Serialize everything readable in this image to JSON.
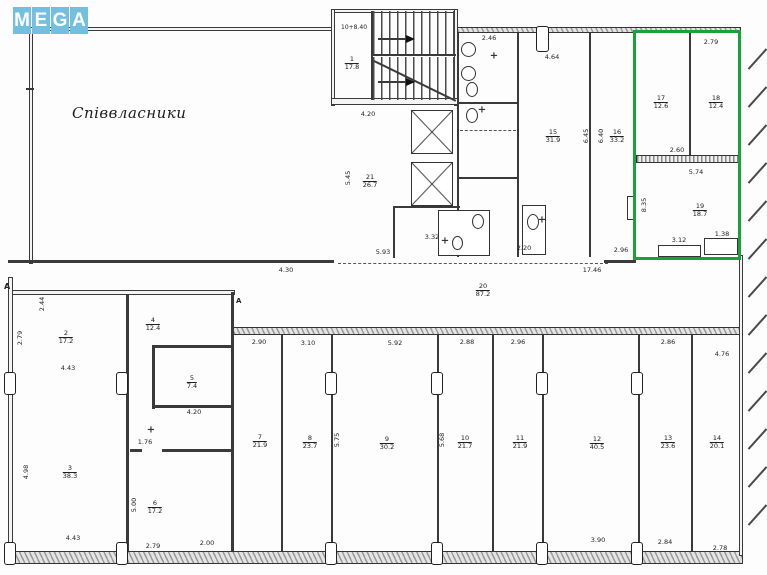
{
  "logo": {
    "letters": [
      "M",
      "E",
      "G",
      "A"
    ]
  },
  "plan": {
    "coowners_label": "Співвласники",
    "stair_level_mark": "10+8.40",
    "section_marker": "А",
    "highlight_color": "#18a33a",
    "rooms": [
      {
        "no": "1",
        "area": "17.8"
      },
      {
        "no": "21",
        "area": "26.7"
      },
      {
        "no": "15",
        "area": "31.9"
      },
      {
        "no": "16",
        "area": "33.2"
      },
      {
        "no": "17",
        "area": "12.6"
      },
      {
        "no": "18",
        "area": "12.4"
      },
      {
        "no": "19",
        "area": "18.7"
      },
      {
        "no": "20",
        "area": "87.2"
      },
      {
        "no": "2",
        "area": "17.2"
      },
      {
        "no": "3",
        "area": "38.3"
      },
      {
        "no": "4",
        "area": "12.4"
      },
      {
        "no": "5",
        "area": "7.4"
      },
      {
        "no": "6",
        "area": "17.2"
      },
      {
        "no": "7",
        "area": "21.9"
      },
      {
        "no": "8",
        "area": "23.7"
      },
      {
        "no": "9",
        "area": "30.2"
      },
      {
        "no": "10",
        "area": "21.7"
      },
      {
        "no": "11",
        "area": "21.9"
      },
      {
        "no": "12",
        "area": "40.5"
      },
      {
        "no": "13",
        "area": "23.6"
      },
      {
        "no": "14",
        "area": "20.1"
      }
    ],
    "dims": [
      {
        "v": "4.20"
      },
      {
        "v": "2.46"
      },
      {
        "v": "5.93"
      },
      {
        "v": "4.30"
      },
      {
        "v": "17.46"
      },
      {
        "v": "2.96"
      },
      {
        "v": "2.79"
      },
      {
        "v": "2.60"
      },
      {
        "v": "5.74"
      },
      {
        "v": "8.35"
      },
      {
        "v": "3.12"
      },
      {
        "v": "1.38"
      },
      {
        "v": "2.90"
      },
      {
        "v": "3.10"
      },
      {
        "v": "5.92"
      },
      {
        "v": "2.88"
      },
      {
        "v": "2.96"
      },
      {
        "v": "2.86"
      },
      {
        "v": "3.90"
      },
      {
        "v": "2.84"
      },
      {
        "v": "2.78"
      },
      {
        "v": "4.43"
      },
      {
        "v": "4.43"
      },
      {
        "v": "4.98"
      },
      {
        "v": "2.79"
      },
      {
        "v": "4.20"
      },
      {
        "v": "2.00"
      },
      {
        "v": "2.79"
      },
      {
        "v": "5.00"
      },
      {
        "v": "5.45"
      },
      {
        "v": "6.45"
      },
      {
        "v": "6.40"
      },
      {
        "v": "5.75"
      },
      {
        "v": "5.68"
      },
      {
        "v": "1.76"
      },
      {
        "v": "4.76"
      },
      {
        "v": "3.32"
      },
      {
        "v": "2.20"
      },
      {
        "v": "4.64"
      },
      {
        "v": "2.44"
      }
    ]
  },
  "icons": {
    "sink_icon": "+"
  }
}
